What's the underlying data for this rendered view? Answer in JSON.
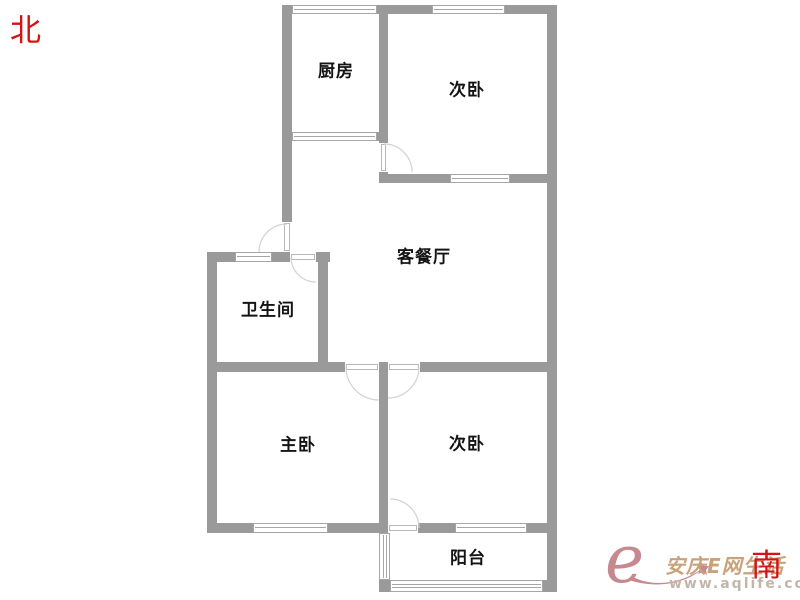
{
  "compass": {
    "north_label": "北",
    "south_label": "南"
  },
  "watermark": {
    "logo": "e",
    "name": "安庆E网生活",
    "url": "www.aqlife.com"
  },
  "colors": {
    "wall": "#9a9a9a",
    "window_line": "#a6a6a6",
    "door_leaf": "#b8b8b8",
    "door_arc": "#d2d2d2",
    "label": "#141414",
    "compass_red": "#d31414",
    "wm_rose": "#c5898f",
    "wm_gold": "#c9a27b",
    "wm_url": "#c2b6a9"
  },
  "floorplan": {
    "canvas": {
      "width": 800,
      "height": 600
    },
    "rooms": [
      {
        "id": "kitchen",
        "label": "厨房",
        "x": 336,
        "y": 69
      },
      {
        "id": "bedroom-north",
        "label": "次卧",
        "x": 467,
        "y": 88
      },
      {
        "id": "living-dining",
        "label": "客餐厅",
        "x": 424,
        "y": 255
      },
      {
        "id": "bathroom",
        "label": "卫生间",
        "x": 268,
        "y": 308
      },
      {
        "id": "master-bedroom",
        "label": "主卧",
        "x": 298,
        "y": 443
      },
      {
        "id": "bedroom-south",
        "label": "次卧",
        "x": 467,
        "y": 442
      },
      {
        "id": "balcony",
        "label": "阳台",
        "x": 468,
        "y": 556
      }
    ],
    "walls": [
      {
        "x": 283,
        "y": 5,
        "w": 9,
        "h": 9
      },
      {
        "x": 377,
        "y": 5,
        "w": 55,
        "h": 9
      },
      {
        "x": 505,
        "y": 5,
        "w": 52,
        "h": 9
      },
      {
        "x": 547,
        "y": 5,
        "w": 10,
        "h": 587
      },
      {
        "x": 282,
        "y": 5,
        "w": 10,
        "h": 217
      },
      {
        "x": 377,
        "y": 132,
        "w": 11,
        "h": 9
      },
      {
        "x": 379,
        "y": 5,
        "w": 9,
        "h": 138
      },
      {
        "x": 379,
        "y": 172,
        "w": 9,
        "h": 11
      },
      {
        "x": 379,
        "y": 174,
        "w": 71,
        "h": 9
      },
      {
        "x": 510,
        "y": 174,
        "w": 47,
        "h": 9
      },
      {
        "x": 207,
        "y": 252,
        "w": 28,
        "h": 10
      },
      {
        "x": 272,
        "y": 252,
        "w": 18,
        "h": 10
      },
      {
        "x": 316,
        "y": 252,
        "w": 14,
        "h": 10
      },
      {
        "x": 207,
        "y": 252,
        "w": 10,
        "h": 281
      },
      {
        "x": 318,
        "y": 252,
        "w": 10,
        "h": 120
      },
      {
        "x": 207,
        "y": 362,
        "w": 138,
        "h": 10
      },
      {
        "x": 379,
        "y": 362,
        "w": 9,
        "h": 10
      },
      {
        "x": 420,
        "y": 362,
        "w": 137,
        "h": 10
      },
      {
        "x": 379,
        "y": 372,
        "w": 9,
        "h": 151
      },
      {
        "x": 207,
        "y": 523,
        "w": 46,
        "h": 10
      },
      {
        "x": 328,
        "y": 523,
        "w": 60,
        "h": 10
      },
      {
        "x": 418,
        "y": 523,
        "w": 37,
        "h": 10
      },
      {
        "x": 527,
        "y": 523,
        "w": 30,
        "h": 10
      },
      {
        "x": 379,
        "y": 580,
        "w": 11,
        "h": 12
      },
      {
        "x": 543,
        "y": 580,
        "w": 14,
        "h": 12
      }
    ],
    "windows": [
      {
        "x": 292,
        "y": 5,
        "w": 85,
        "h": 9,
        "o": "h"
      },
      {
        "x": 432,
        "y": 5,
        "w": 73,
        "h": 9,
        "o": "h"
      },
      {
        "x": 292,
        "y": 132,
        "w": 85,
        "h": 9,
        "o": "h"
      },
      {
        "x": 450,
        "y": 174,
        "w": 60,
        "h": 9,
        "o": "h"
      },
      {
        "x": 235,
        "y": 252,
        "w": 37,
        "h": 10,
        "o": "h"
      },
      {
        "x": 253,
        "y": 523,
        "w": 75,
        "h": 10,
        "o": "h"
      },
      {
        "x": 455,
        "y": 523,
        "w": 72,
        "h": 10,
        "o": "h"
      },
      {
        "x": 379,
        "y": 533,
        "w": 11,
        "h": 47,
        "o": "v3"
      },
      {
        "x": 390,
        "y": 580,
        "w": 153,
        "h": 12,
        "o": "h3"
      }
    ],
    "doors": [
      {
        "id": "entry-door",
        "gap": {
          "x": 282,
          "y": 222,
          "w": 10,
          "h": 30
        },
        "arc": "M 287 224 A 28 28 0 0 0 259 252"
      },
      {
        "id": "bedroom-north-door",
        "gap": {
          "x": 379,
          "y": 143,
          "w": 9,
          "h": 29
        },
        "arc": "M 384 144 A 28 28 0 0 1 412 172"
      },
      {
        "id": "bathroom-door",
        "gap": {
          "x": 290,
          "y": 252,
          "w": 26,
          "h": 10
        },
        "arc": "M 291 257 A 25 25 0 0 0 316 282"
      },
      {
        "id": "master-bedroom-door",
        "gap": {
          "x": 345,
          "y": 362,
          "w": 34,
          "h": 10
        },
        "arc": "M 346 367 A 33 33 0 0 0 379 400"
      },
      {
        "id": "bedroom-south-door",
        "gap": {
          "x": 388,
          "y": 362,
          "w": 32,
          "h": 10
        },
        "arc": "M 419 367 A 31 31 0 0 1 388 398"
      },
      {
        "id": "balcony-door",
        "gap": {
          "x": 388,
          "y": 523,
          "w": 30,
          "h": 10
        },
        "arc": "M 419 528 A 29 29 0 0 0 390 499"
      }
    ]
  }
}
